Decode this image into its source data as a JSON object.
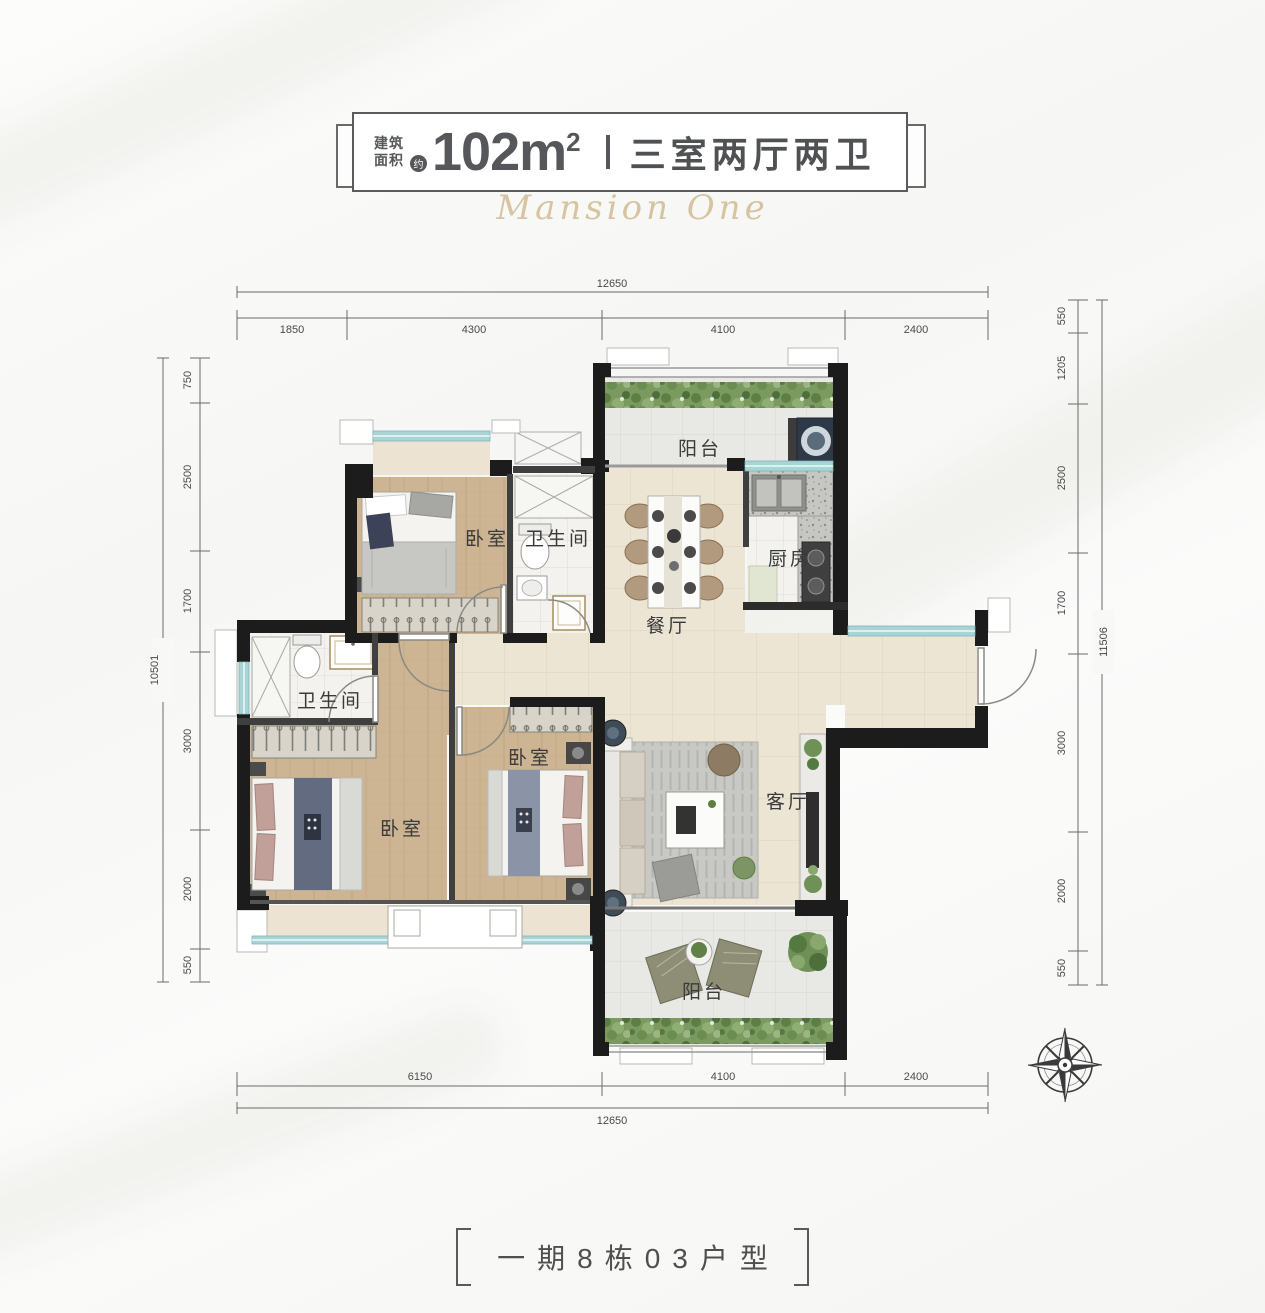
{
  "header": {
    "area_prefix_line1": "建筑",
    "area_prefix_line2": "面积",
    "approx": "约",
    "area_value": "102m",
    "area_sup": "2",
    "layout": "三室两厅两卫"
  },
  "watermark": {
    "text": "Mansion One"
  },
  "rooms": {
    "balcony_top": "阳台",
    "dining": "餐厅",
    "kitchen": "厨房",
    "bedroom_top": "卧室",
    "bath_top": "卫生间",
    "bath_left": "卫生间",
    "bedroom_master": "卧室",
    "bedroom_mid": "卧室",
    "living": "客厅",
    "balcony_bottom": "阳台"
  },
  "dimensions": {
    "top": {
      "total": "12650",
      "segs": [
        "1850",
        "4300",
        "4100",
        "2400"
      ]
    },
    "bottom": {
      "total": "12650",
      "segs": [
        "6150",
        "4100",
        "2400"
      ]
    },
    "left": {
      "total": "10501",
      "segs": [
        "750",
        "2500",
        "1700",
        "3000",
        "2000",
        "550"
      ]
    },
    "right": {
      "total": "11506",
      "segs": [
        "550",
        "1205",
        "2500",
        "1700",
        "3000",
        "2000",
        "550"
      ]
    }
  },
  "footer": {
    "unit": "一期8栋03户型"
  },
  "colors": {
    "wall": "#1c1c1c",
    "window": "#a9d4d6",
    "wood_floor": "#cdb493",
    "tile_cream": "#ece5d4",
    "tile_gray": "#e8e8e5",
    "plant_green": "#6f9158",
    "accent_gold": "#cfb88c",
    "text_dark": "#4f5153"
  }
}
